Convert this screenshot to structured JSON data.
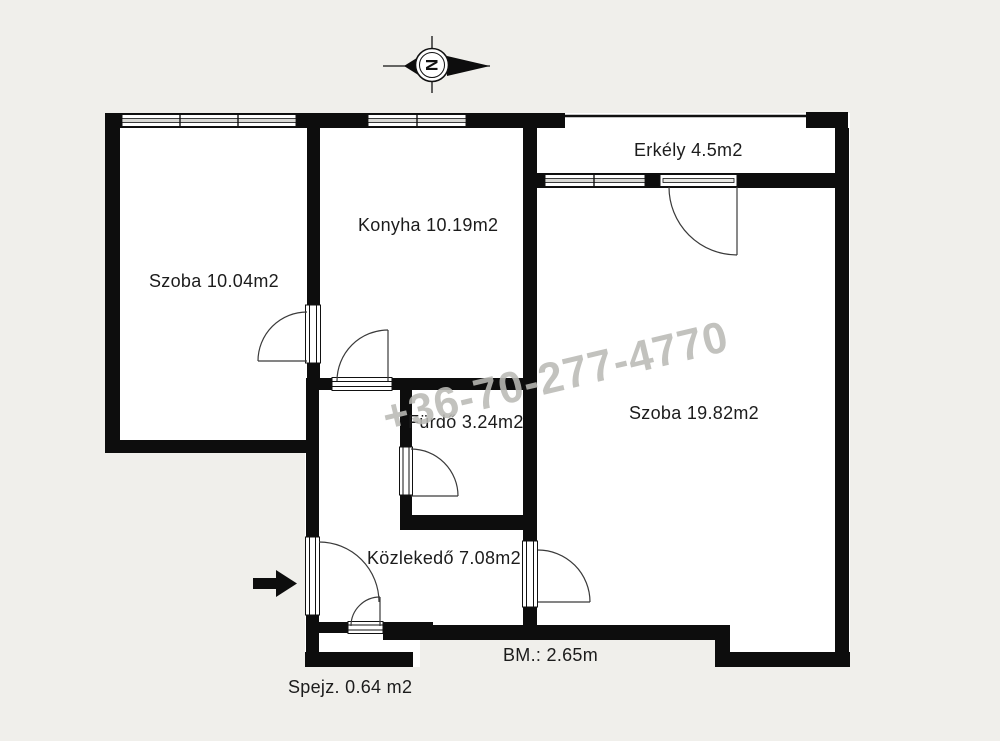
{
  "page": {
    "background_color": "#f0efeb",
    "interior_color": "#ffffff",
    "wall_color": "#0d0d0d",
    "watermark_color": "#bab9b5"
  },
  "rooms": [
    {
      "id": "erkely",
      "name": "Erkély",
      "area_m2": 4.5,
      "label": "Erkély 4.5m2"
    },
    {
      "id": "konyha",
      "name": "Konyha",
      "area_m2": 10.19,
      "label": "Konyha 10.19m2"
    },
    {
      "id": "szoba_small",
      "name": "Szoba",
      "area_m2": 10.04,
      "label": "Szoba 10.04m2"
    },
    {
      "id": "szoba_large",
      "name": "Szoba",
      "area_m2": 19.82,
      "label": "Szoba 19.82m2"
    },
    {
      "id": "furdo",
      "name": "Fürdő",
      "area_m2": 3.24,
      "label": "Fürdő 3.24m2"
    },
    {
      "id": "kozlekedo",
      "name": "Közlekedő",
      "area_m2": 7.08,
      "label": "Közlekedő 7.08m2"
    },
    {
      "id": "spejz",
      "name": "Spejz.",
      "area_m2": 0.64,
      "label": "Spejz. 0.64 m2"
    }
  ],
  "annotations": {
    "ceiling_height": "BM.: 2.65m",
    "watermark_phone": "+36-70-277-4770",
    "compass_letter": "N"
  }
}
